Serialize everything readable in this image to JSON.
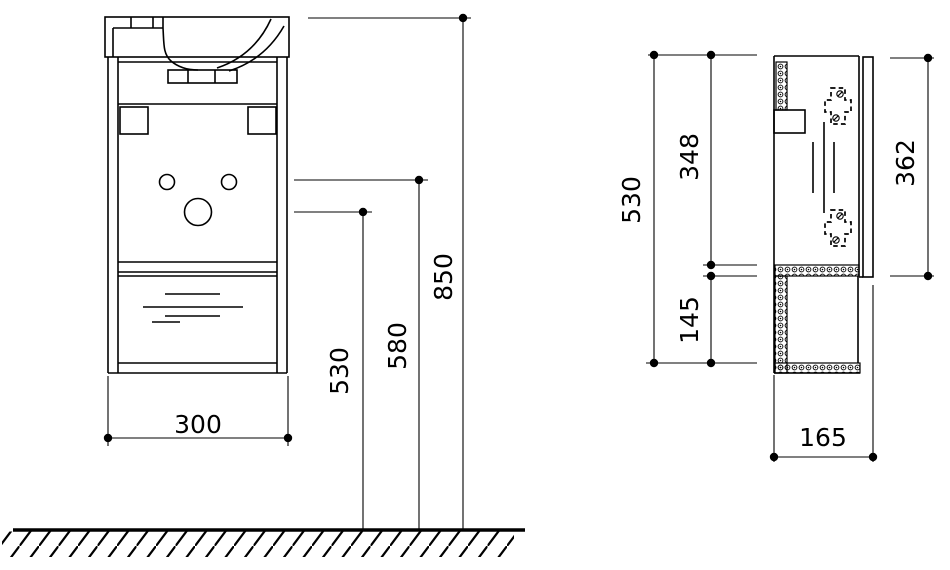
{
  "colors": {
    "line": "#000000",
    "background": "#ffffff"
  },
  "front_view": {
    "dim_cabinet_width": "300",
    "dim_siphon_height": "530",
    "dim_supply_height": "580",
    "dim_basin_top_height": "850"
  },
  "side_view": {
    "dim_body_height": "530",
    "dim_upper_section_height": "348",
    "dim_shelf_section_height": "145",
    "dim_door_height": "362",
    "dim_depth": "165"
  }
}
